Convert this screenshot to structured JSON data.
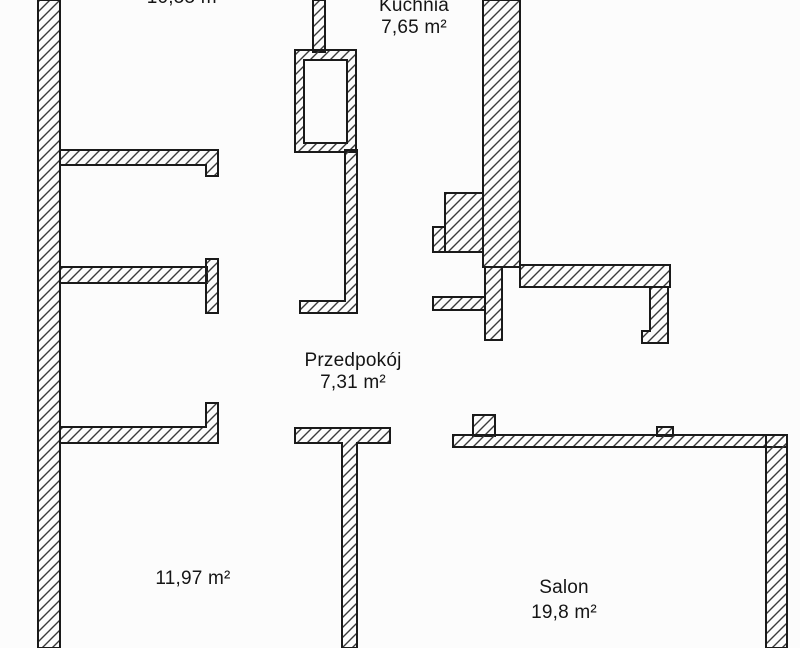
{
  "title": "Apartment floor plan",
  "colors": {
    "wall_outline": "#1a1a1a",
    "hatch": "#3a3a3a",
    "background": "#fcfcfc",
    "text": "#151515"
  },
  "rooms": {
    "top_room": {
      "area": "10,55 m²"
    },
    "kuchnia": {
      "name": "Kuchnia",
      "area": "7,65 m²"
    },
    "przedpokoj": {
      "name": "Przedpokój",
      "area": "7,31 m²"
    },
    "room_center": {
      "area": "11,97 m²"
    },
    "salon": {
      "name": "Salon",
      "area": "19,8 m²"
    }
  }
}
